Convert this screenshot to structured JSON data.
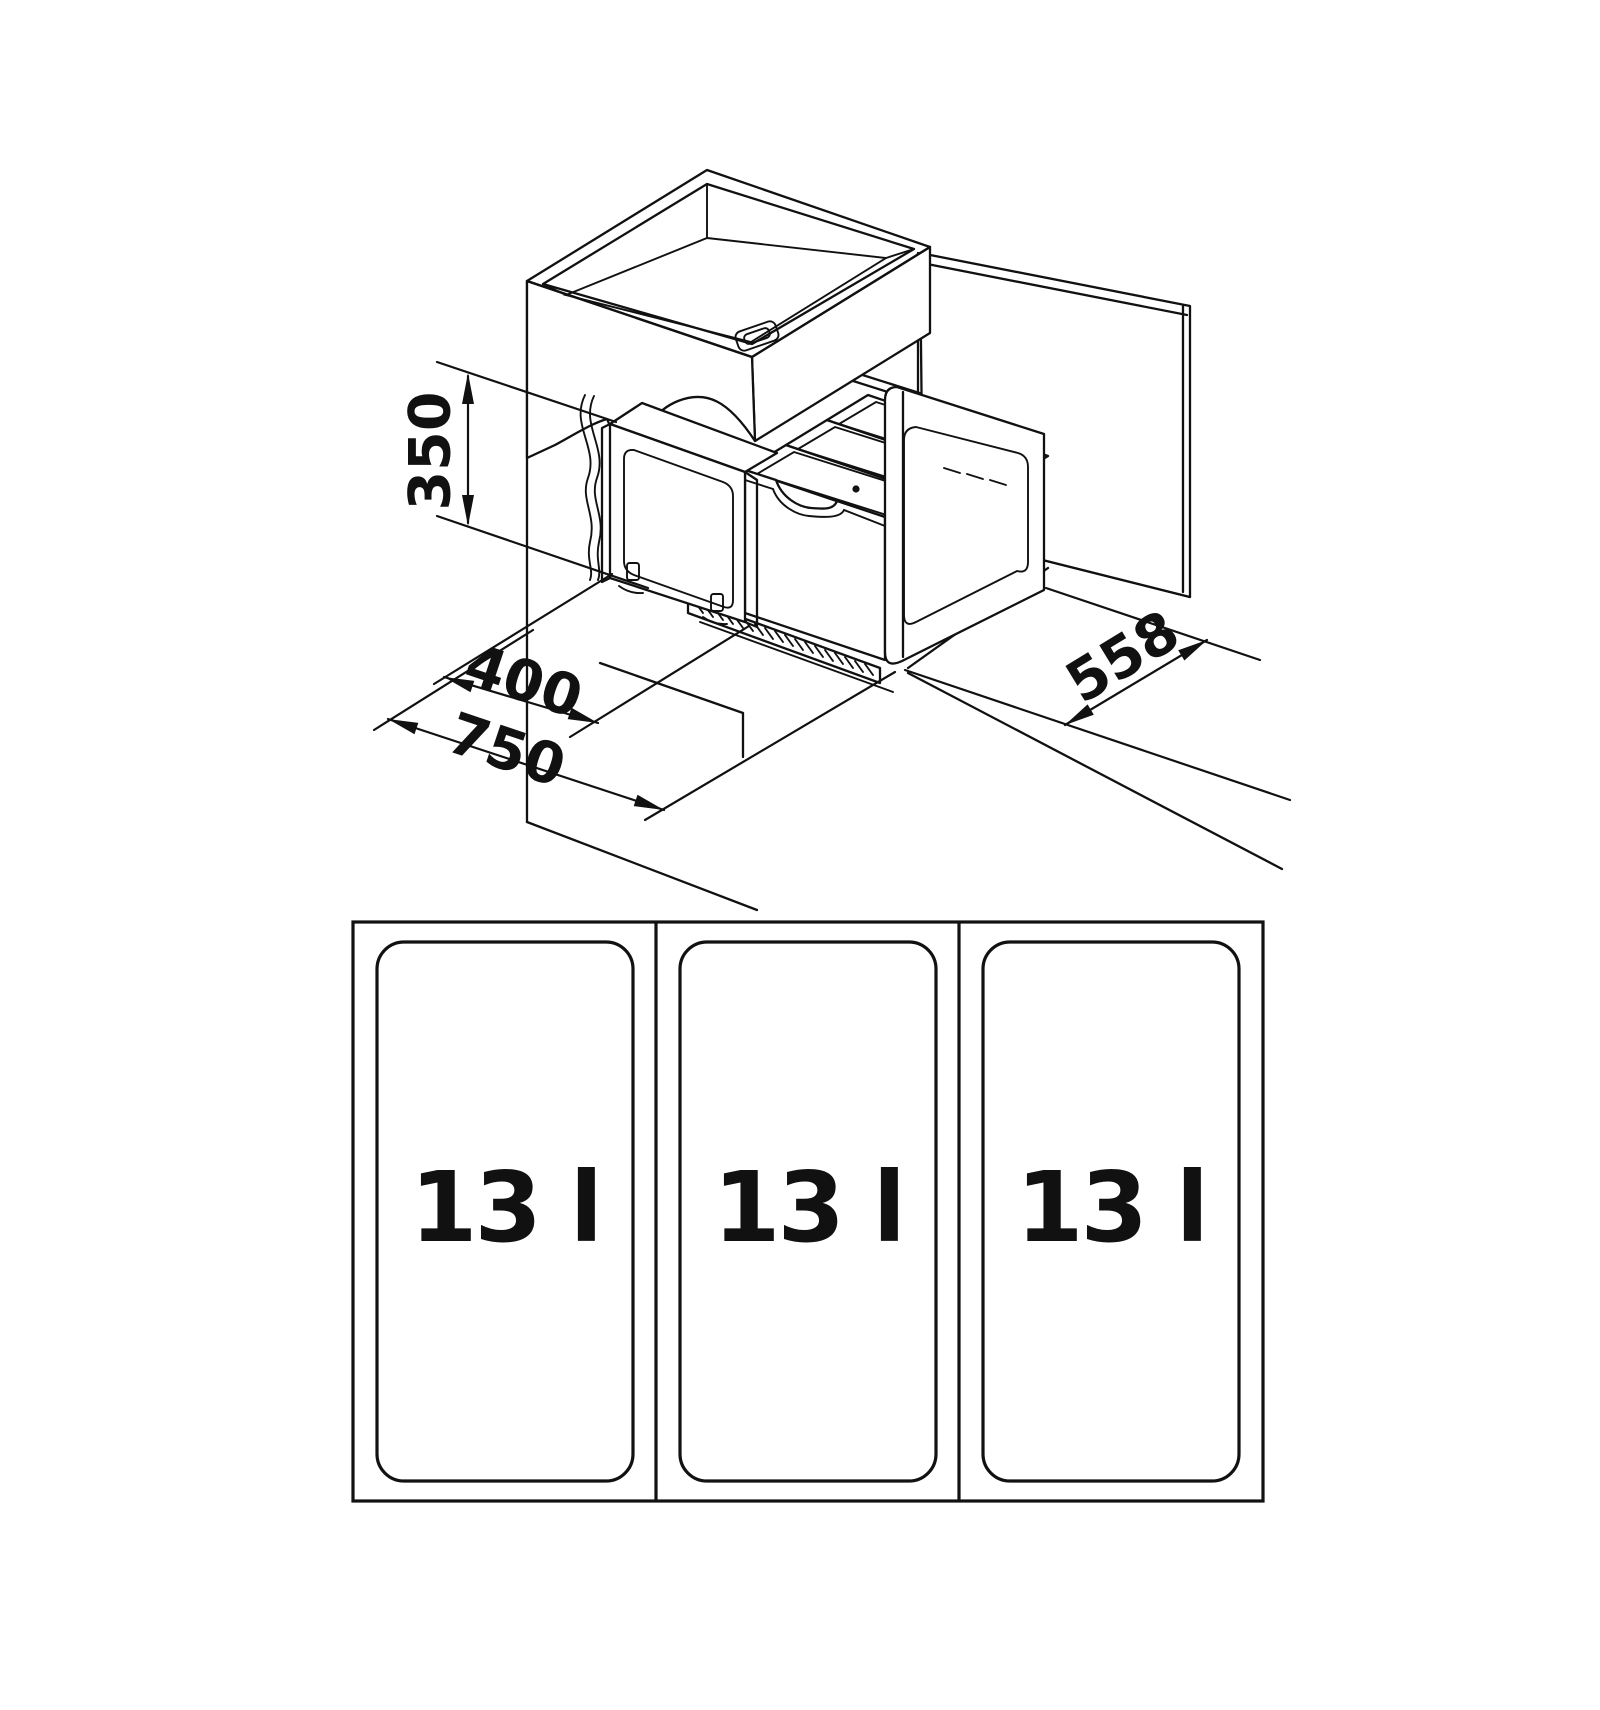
{
  "page": {
    "background": "#ffffff",
    "line_color": "#111111",
    "description": "Technical installation drawing of an under-sink cabinet with pull-out waste bin system: isometric view with dimensions and plan view of three bins"
  },
  "isometric_view": {
    "dimensions": [
      {
        "id": "height",
        "label": "350"
      },
      {
        "id": "door_width",
        "label": "400"
      },
      {
        "id": "cabinet_width",
        "label": "750"
      },
      {
        "id": "depth",
        "label": "558"
      }
    ]
  },
  "plan_view": {
    "bins": [
      {
        "label": "13 l"
      },
      {
        "label": "13 l"
      },
      {
        "label": "13 l"
      }
    ]
  }
}
